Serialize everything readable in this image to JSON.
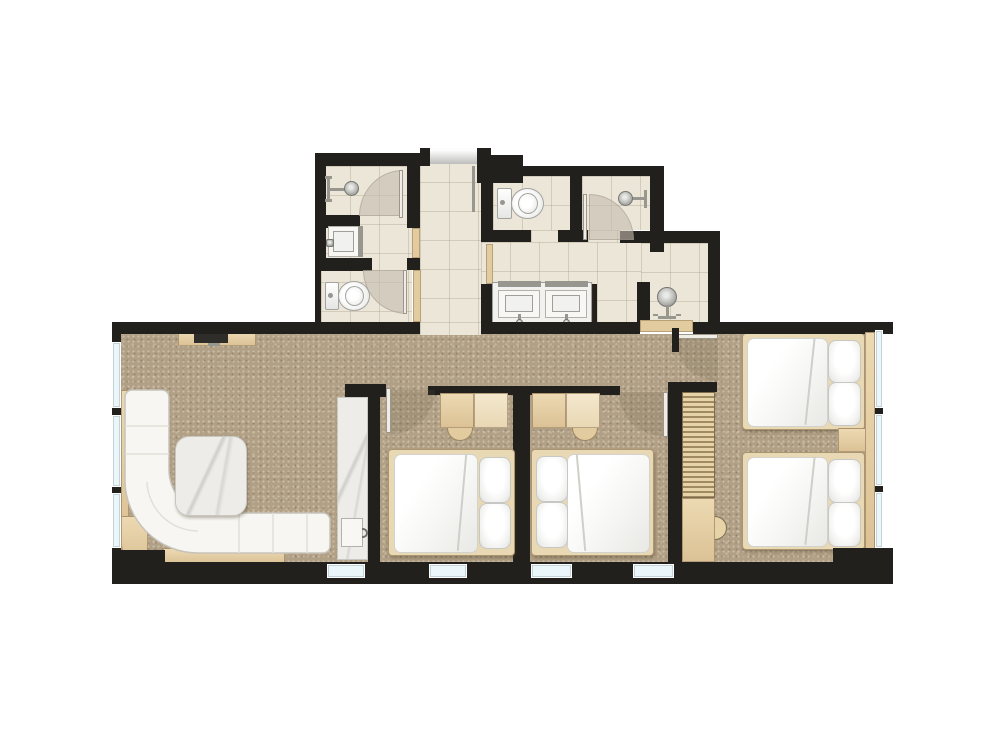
{
  "meta": {
    "type": "architectural-floor-plan",
    "description": "Hotel suite floor plan: entry hall and three tiled bathrooms on the upper wing; carpeted lower wing with living room, wardrobe niche with minibar, three bedrooms with four beds, desks, louvered closet and window walls",
    "canvas_width": 1000,
    "canvas_height": 750
  },
  "palette": {
    "wall": "#22201d",
    "carpet": "#b1a085",
    "tile": "#ece6d8",
    "wood": "#e4cda2",
    "threshold": "#e3cba0",
    "marble": "#edece8",
    "white_furniture": "#f8f7f4",
    "window_glass": "#eaf6f9",
    "door_swing": "#c4bdaf",
    "bed_frame": "#e9d8b4",
    "louver": "#9f8a62"
  },
  "rooms": [
    {
      "id": "entry-hall",
      "label": "Entry hall",
      "floor": "tile",
      "features": [
        "entry-door"
      ]
    },
    {
      "id": "bathroom-left",
      "label": "Left bathroom",
      "floor": "tile",
      "fixtures": [
        "shower",
        "washbasin",
        "toilet"
      ]
    },
    {
      "id": "bathroom-middle",
      "label": "Middle bathroom",
      "floor": "tile",
      "fixtures": [
        "toilet",
        "shower",
        "double-vanity"
      ]
    },
    {
      "id": "shower-room-right",
      "label": "Right shower room",
      "floor": "tile",
      "fixtures": [
        "shower-column"
      ]
    },
    {
      "id": "living-room",
      "label": "Living room",
      "floor": "carpet",
      "furniture": [
        "corner-sofa",
        "coffee-table",
        "tv-console"
      ]
    },
    {
      "id": "wardrobe-niche",
      "label": "Wardrobe niche",
      "floor": "marble",
      "furniture": [
        "minibar"
      ]
    },
    {
      "id": "bedroom-1",
      "label": "Bedroom 1",
      "floor": "carpet",
      "furniture": [
        "double-bed",
        "desk",
        "chair"
      ]
    },
    {
      "id": "bedroom-2",
      "label": "Bedroom 2",
      "floor": "carpet",
      "furniture": [
        "double-bed",
        "desk",
        "chair"
      ]
    },
    {
      "id": "bedroom-3",
      "label": "Bedroom 3",
      "floor": "carpet",
      "furniture": [
        "double-bed",
        "double-bed",
        "nightstand",
        "louvered-closet"
      ]
    }
  ],
  "counts": {
    "beds": 4,
    "pillows": 8,
    "toilets": 2,
    "showers": 3,
    "washbasins": 3,
    "vanity_sinks": 2,
    "desks": 2,
    "chairs": 2,
    "sofas": 1,
    "door_swings": 8,
    "windows_bottom_wall": 4,
    "windows_left_wall": 3,
    "windows_right_wall": 3
  }
}
